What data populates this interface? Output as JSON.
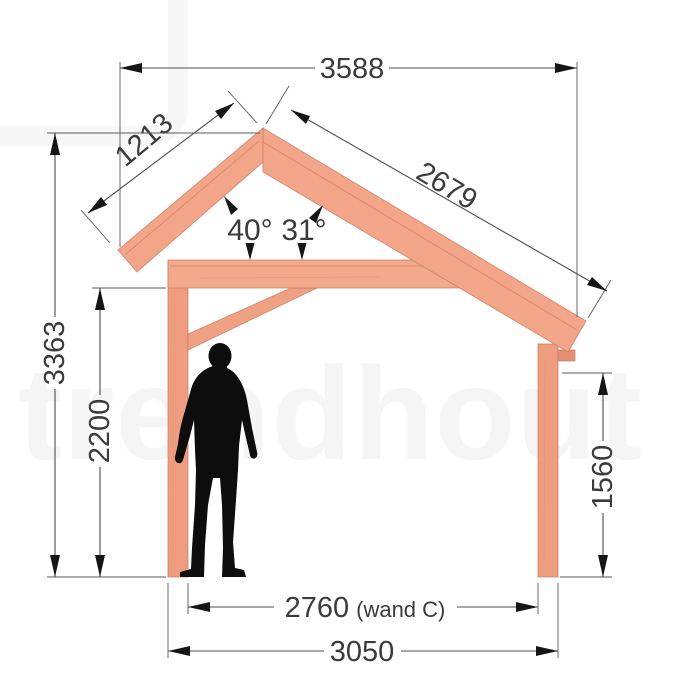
{
  "diagram": {
    "title": "timber-frame-canopy-side-elevation",
    "watermark": "trendhout",
    "labels": {
      "top_width": "3588",
      "left_rafter_length": "1213",
      "right_rafter_length": "2679",
      "left_roof_angle": "40°",
      "right_roof_angle": "31°",
      "total_height": "3363",
      "clearance_height": "2200",
      "right_post_height": "1560",
      "inner_span": "2760",
      "inner_span_suffix": "(wand C)",
      "outer_span": "3050"
    },
    "colors": {
      "wood": "#f2a588",
      "wood_light": "#f6b296",
      "wood_dark": "#ea9a7c",
      "dimension_line": "#4d4d4d",
      "text": "#3b3b3b",
      "silhouette": "#0d0d0d"
    }
  }
}
